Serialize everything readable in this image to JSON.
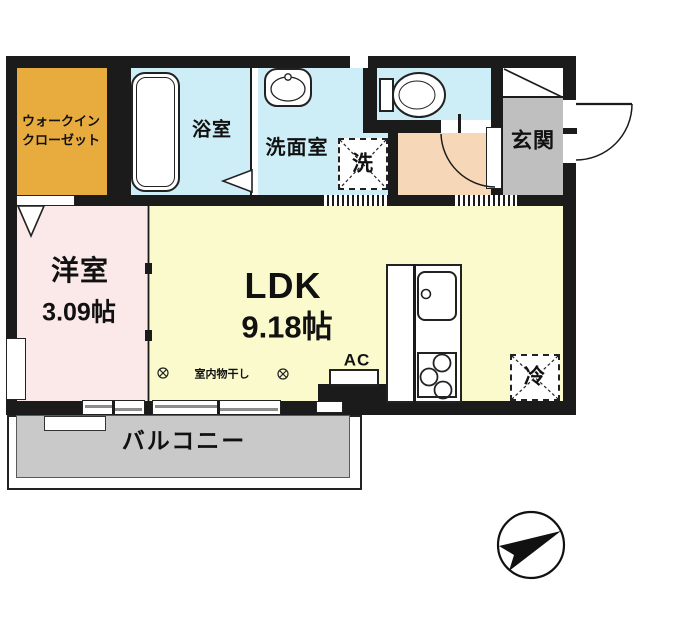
{
  "plan_title": "1LDK floor plan",
  "colors": {
    "wall": "#1b1b1b",
    "wic": "#E8AC3E",
    "wet_rooms": "#CDEEF6",
    "hall": "#F6D8B9",
    "entrance": "#BFBFBF",
    "western_room": "#FBE9E9",
    "ldk": "#FAFACD",
    "balcony_deck": "#C9C9C9"
  },
  "rooms": {
    "walk_in_closet": {
      "label_line1": "ウォークイン",
      "label_line2": "クローゼット"
    },
    "bathroom": {
      "label": "浴室"
    },
    "washroom": {
      "label": "洗面室"
    },
    "laundry_space": {
      "label": "洗"
    },
    "entrance": {
      "label": "玄関"
    },
    "western_room": {
      "name": "洋室",
      "size": "3.09帖"
    },
    "ldk": {
      "name": "LDK",
      "size": "9.18帖"
    },
    "balcony": {
      "label": "バルコニー"
    }
  },
  "fixtures": {
    "air_conditioner": {
      "label": "AC"
    },
    "indoor_drying": {
      "label": "室内物干し"
    },
    "refrigerator_space": {
      "label": "冷"
    }
  }
}
